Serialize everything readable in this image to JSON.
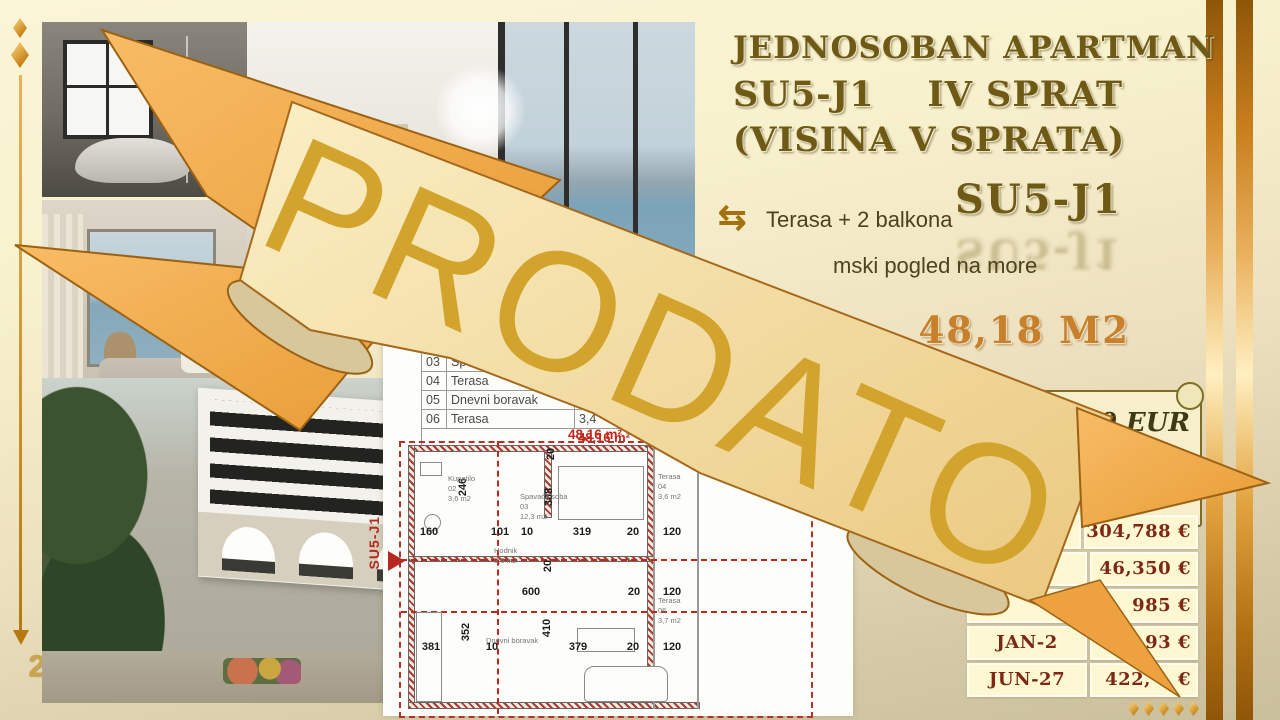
{
  "page": {
    "number": "26"
  },
  "title": {
    "line1": "JEDNOSOBAN APARTMAN",
    "line2": "SU5-J1    IV SPRAT",
    "line3": "(VISINA V SPRATA)",
    "unit_code": "SU5-J1",
    "area_label": "48,18 M2"
  },
  "features": [
    {
      "icon": "swap-arrows-icon",
      "label": "Terasa + 2 balkona"
    },
    {
      "icon": null,
      "label": "mski pogled na more"
    }
  ],
  "banner": {
    "text": "PRODATO"
  },
  "parchment": {
    "line1": "00 EUR"
  },
  "price_table": {
    "rows": [
      {
        "date": "",
        "price": "304,788 €"
      },
      {
        "date": "",
        "price": "46,350 €"
      },
      {
        "date": "",
        "price": "985 €"
      },
      {
        "date": "JAN-2",
        "price": "93 €"
      },
      {
        "date": "JUN-27",
        "price": "422,    €"
      }
    ]
  },
  "room_table": {
    "rows": [
      {
        "num": "03",
        "name": "Spa",
        "area": ""
      },
      {
        "num": "04",
        "name": "Terasa",
        "area": ""
      },
      {
        "num": "05",
        "name": "Dnevni boravak",
        "area": ""
      },
      {
        "num": "06",
        "name": "Terasa",
        "area": "3,4"
      }
    ],
    "total": "48,16 m²"
  },
  "floorplan": {
    "unit_label": "SU5-J1",
    "total_area": "48,16 m²",
    "dims": [
      {
        "x": 429,
        "y": 526,
        "t": "160",
        "r": 0
      },
      {
        "x": 500,
        "y": 526,
        "t": "101",
        "r": 0
      },
      {
        "x": 527,
        "y": 526,
        "t": "10",
        "r": 0
      },
      {
        "x": 582,
        "y": 526,
        "t": "319",
        "r": 0
      },
      {
        "x": 633,
        "y": 526,
        "t": "20",
        "r": 0
      },
      {
        "x": 672,
        "y": 526,
        "t": "120",
        "r": 0
      },
      {
        "x": 531,
        "y": 586,
        "t": "600",
        "r": 0
      },
      {
        "x": 634,
        "y": 586,
        "t": "20",
        "r": 0
      },
      {
        "x": 672,
        "y": 586,
        "t": "120",
        "r": 0
      },
      {
        "x": 431,
        "y": 641,
        "t": "381",
        "r": 0
      },
      {
        "x": 492,
        "y": 641,
        "t": "10",
        "r": 0
      },
      {
        "x": 578,
        "y": 641,
        "t": "379",
        "r": 0
      },
      {
        "x": 633,
        "y": 641,
        "t": "20",
        "r": 0
      },
      {
        "x": 672,
        "y": 641,
        "t": "120",
        "r": 0
      },
      {
        "x": 466,
        "y": 632,
        "t": "352",
        "r": 1
      },
      {
        "x": 463,
        "y": 487,
        "t": "246",
        "r": 1
      },
      {
        "x": 549,
        "y": 497,
        "t": "308",
        "r": 1
      },
      {
        "x": 547,
        "y": 628,
        "t": "410",
        "r": 1
      },
      {
        "x": 551,
        "y": 454,
        "t": "20",
        "r": 1
      },
      {
        "x": 548,
        "y": 566,
        "t": "20",
        "r": 1
      }
    ],
    "rooms": [
      {
        "x": 448,
        "y": 474,
        "lines": [
          "Kupatilo",
          "02",
          "3,6 m2"
        ]
      },
      {
        "x": 520,
        "y": 492,
        "lines": [
          "Spavaća soba",
          "03",
          "12,3 m2"
        ]
      },
      {
        "x": 494,
        "y": 546,
        "lines": [
          "Hodnik",
          "3,6 m2"
        ]
      },
      {
        "x": 658,
        "y": 472,
        "lines": [
          "Terasa",
          "04",
          "3,6 m2"
        ]
      },
      {
        "x": 486,
        "y": 636,
        "lines": [
          "Dnevni boravak"
        ]
      },
      {
        "x": 658,
        "y": 596,
        "lines": [
          "Terasa",
          "06",
          "3,7 m2"
        ]
      }
    ]
  },
  "photos": {
    "bathroom": "bathroom-photo",
    "living_room": "living-room-photo",
    "bedroom": "bedroom-photo",
    "building": "building-exterior-photo",
    "kitchen": "kitchen-photo"
  },
  "colors": {
    "accent_gold": "#d2a42e",
    "title_brown": "#6e5a14",
    "price_red": "#7c2815",
    "plan_red": "#b23327",
    "ribbon_orange": "#f2a94e"
  }
}
